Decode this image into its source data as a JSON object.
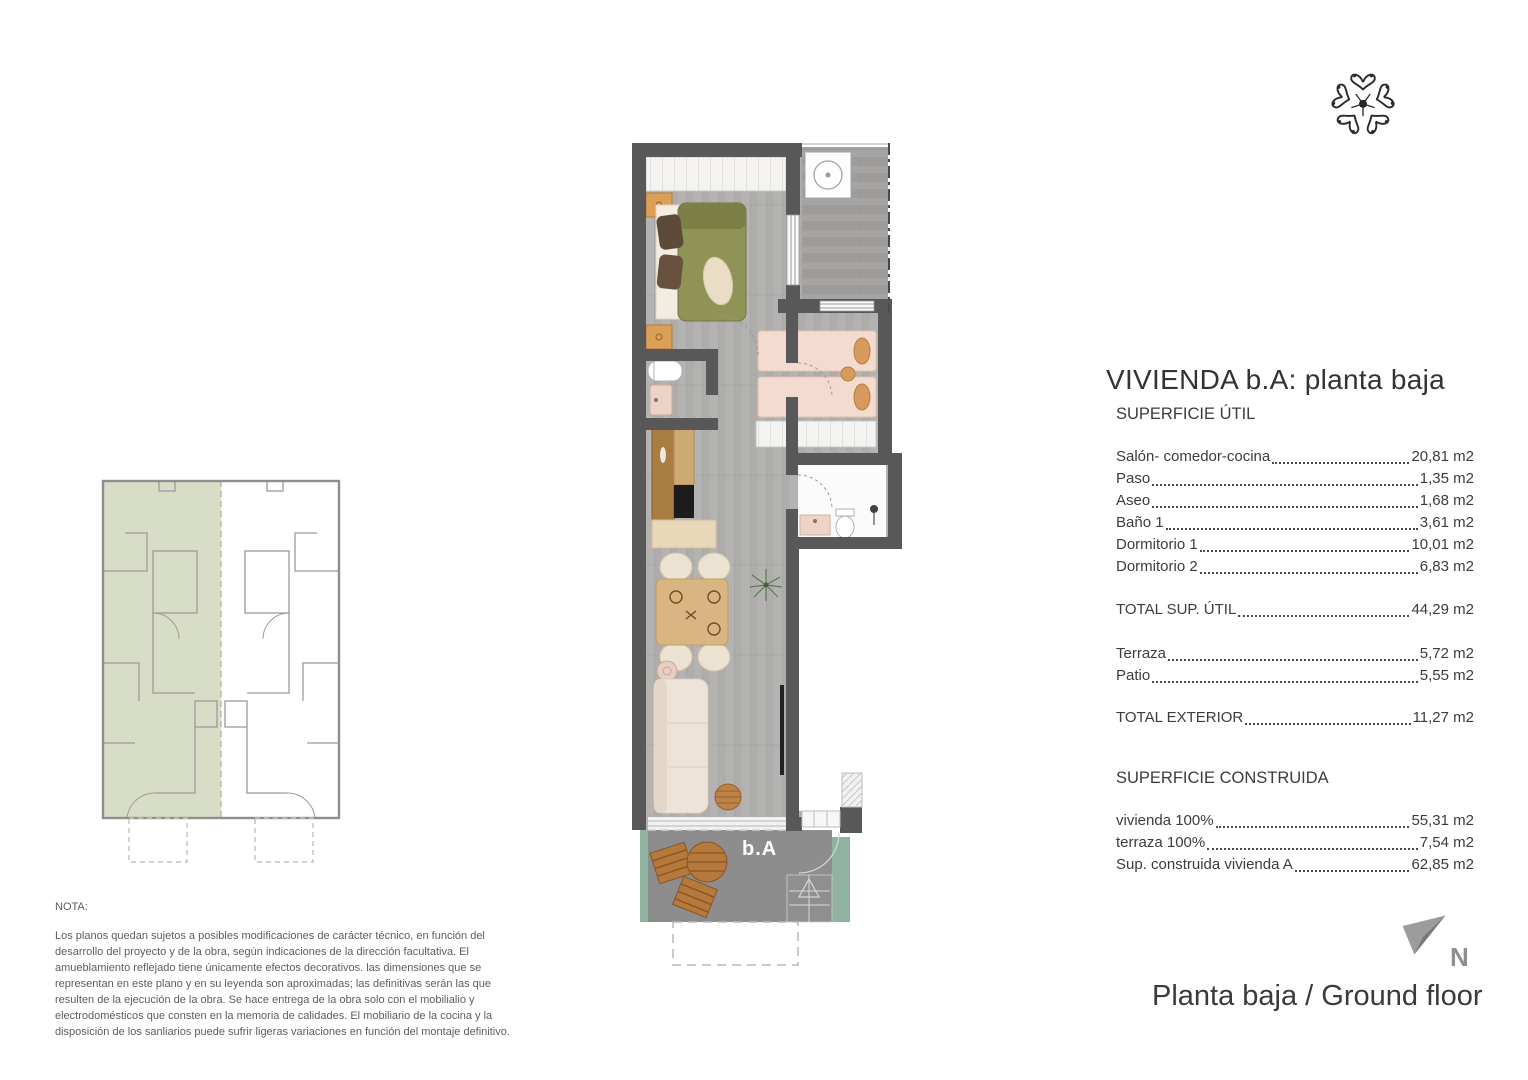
{
  "panel": {
    "title": "VIVIENDA b.A: planta baja",
    "section_util_header": "SUPERFICIE ÚTIL",
    "rows_util": [
      {
        "label": "Salón- comedor-cocina",
        "value": "20,81 m2"
      },
      {
        "label": "Paso",
        "value": "1,35 m2"
      },
      {
        "label": "Aseo",
        "value": "1,68 m2"
      },
      {
        "label": "Baño 1",
        "value": "3,61 m2"
      },
      {
        "label": "Dormitorio 1",
        "value": "10,01 m2"
      },
      {
        "label": "Dormitorio 2",
        "value": "6,83 m2"
      }
    ],
    "total_util": {
      "label": "TOTAL SUP. ÚTIL",
      "value": "44,29 m2"
    },
    "rows_exterior": [
      {
        "label": "Terraza",
        "value": "5,72 m2"
      },
      {
        "label": "Patio",
        "value": "5,55 m2"
      }
    ],
    "total_exterior": {
      "label": "TOTAL EXTERIOR",
      "value": "11,27 m2"
    },
    "section_construida_header": "SUPERFICIE CONSTRUIDA",
    "rows_construida": [
      {
        "label": "vivienda 100%",
        "value": "55,31 m2"
      },
      {
        "label": "terraza 100%",
        "value": "7,54 m2"
      },
      {
        "label": "Sup. construida vivienda A",
        "value": "62,85 m2"
      }
    ]
  },
  "nota": {
    "heading": "NOTA:",
    "body": "Los planos quedan sujetos a posibles modificaciones de carácter técnico, en función del desarrollo del proyecto y de la obra, según indicaciones de la dirección facultativa. El amueblamiento reflejado tiene únicamente efectos decorativos. las dimensiones que se representan en este plano y en su leyenda son aproximadas; las definitivas serán las que resulten de la ejecución de la obra. Se hace entrega de la obra solo con el mobilialio y electrodomésticos que consten en la memoria de calidades. El mobiliario de la cocina y la disposición de los sanliarios puede sufrir ligeras variaciones en función del montaje definitivo."
  },
  "plan": {
    "unit_label": "b.A",
    "north_letter": "N"
  },
  "footer": {
    "caption": "Planta baja / Ground floor"
  },
  "colors": {
    "wall_gray": "#585858",
    "terrace_green": "#8fb3a0",
    "keyplan_highlight": "#d8ddc6",
    "text_dark": "#3c3c3c"
  }
}
